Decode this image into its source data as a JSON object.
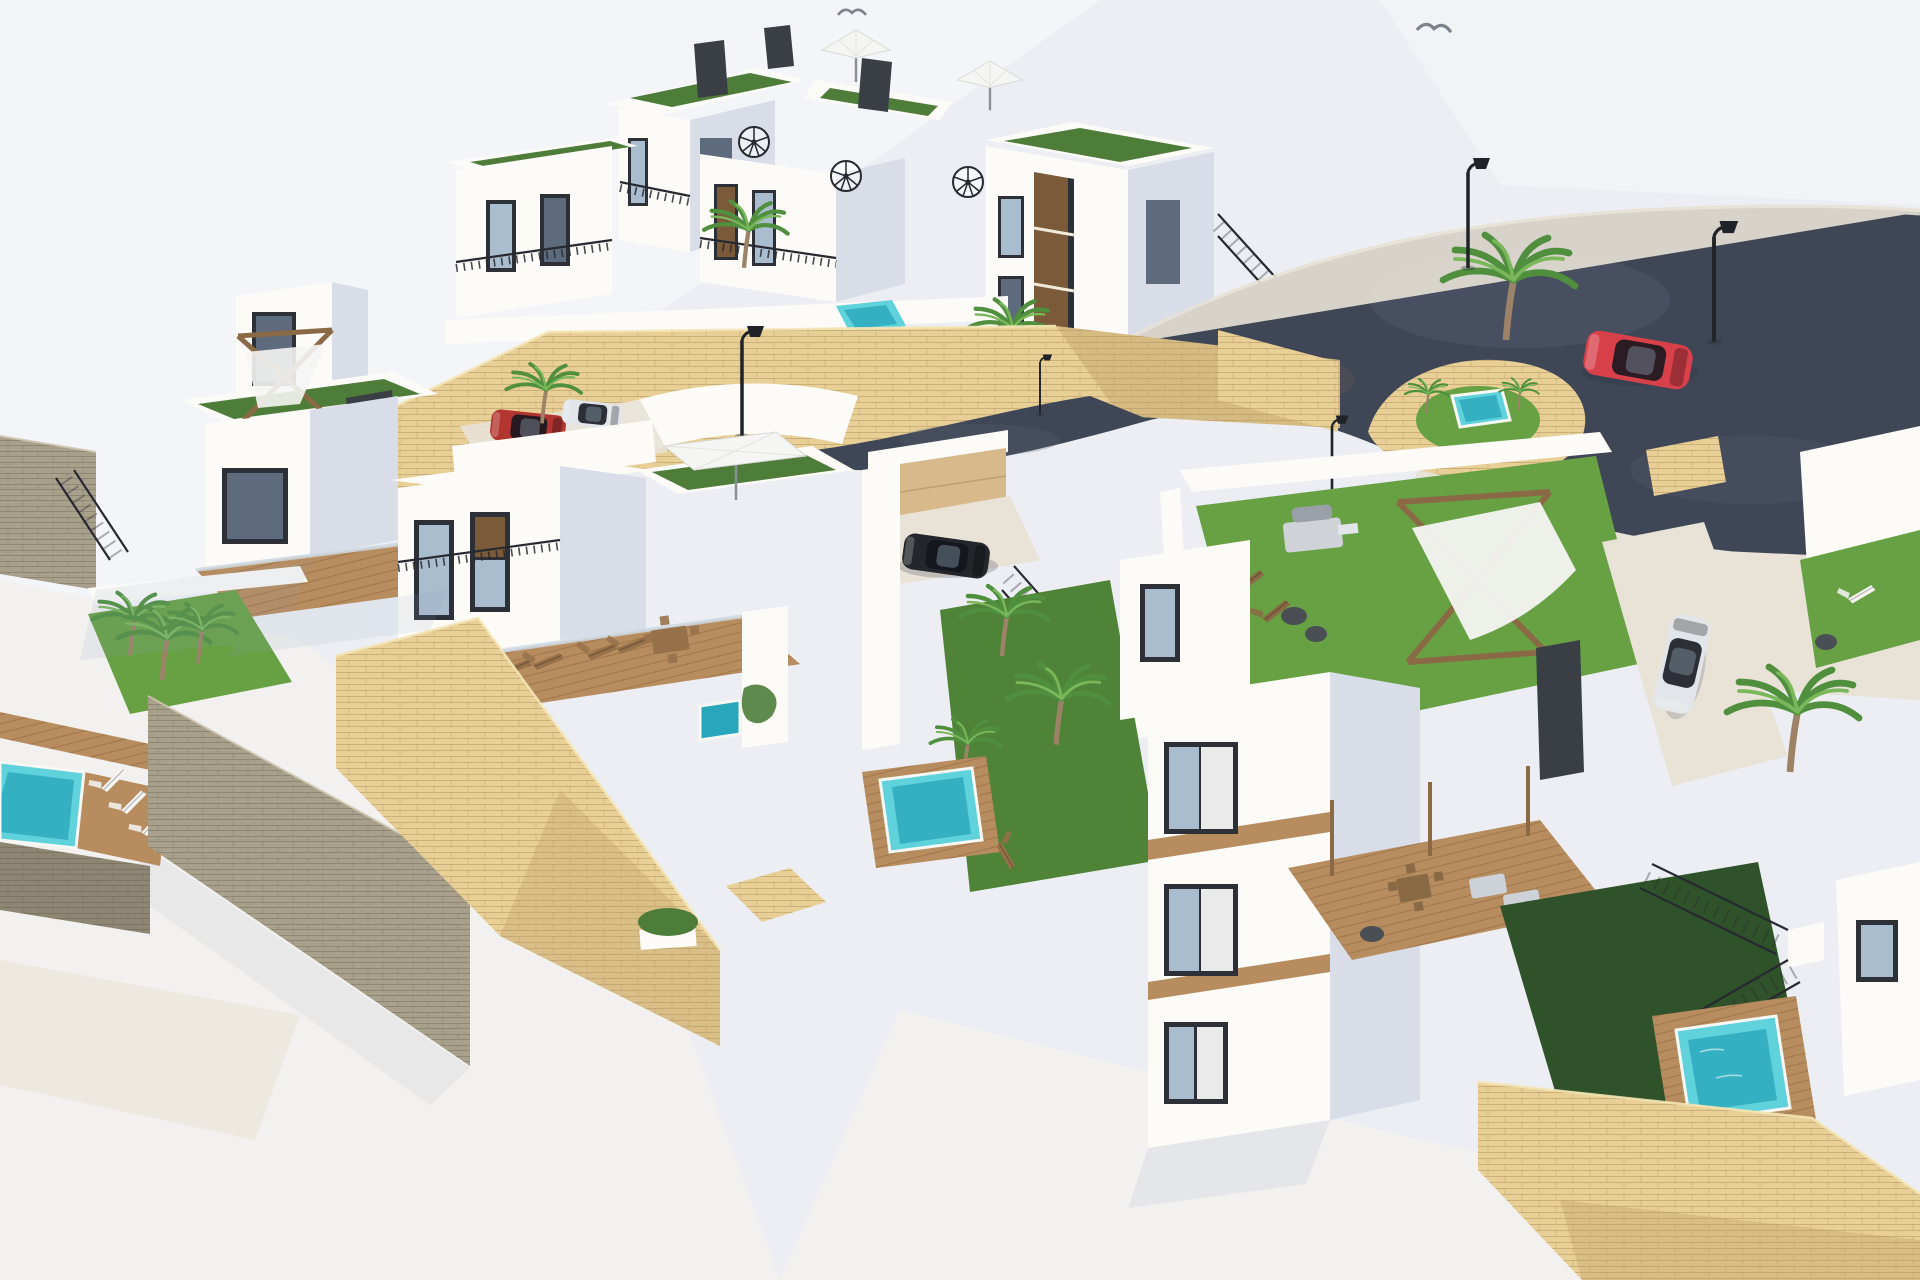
{
  "scene": {
    "kind": "3D architectural rendering",
    "view": "aerial three-quarter view",
    "subject": "Hillside residential development of modern white villas with rooftop terraces, private pools, palm trees, sandstone retaining walls and a curving access road",
    "text_on_screen": "none"
  },
  "palette": {
    "skyBase": "#eceef3",
    "skyHigh": "#f6f7f9",
    "groundLight": "#f2f1ef",
    "groundWarm": "#eae2d4",
    "villaLit": "#fcfbf8",
    "villaCream": "#f3ead8",
    "villaShade": "#d8dde8",
    "villaDark": "#c2cbdb",
    "panelDark": "#3a3f46",
    "windowFrame": "#2d3137",
    "windowGlass": "#aabdce",
    "glassDark": "#5e6b7c",
    "panelBrown": "#7b5a3a",
    "turfRoof": "#4e7d3a",
    "turfBright": "#67a144",
    "turfMid": "#4f8337",
    "turfDark": "#30522a",
    "stoneLit": "#e8cf96",
    "stoneMid": "#d8ba7c",
    "stoneShade": "#b2945f",
    "stoneGray": "#a9a08c",
    "stoneGrayDark": "#8e8673",
    "tileTan": "#d8b98c",
    "deckWood": "#b78c5e",
    "deckWoodDark": "#97714a",
    "poolLight": "#5fd2dc",
    "poolDeep": "#2aa6bc",
    "roadAsphalt": "#3f4756",
    "roadLight": "#5d6577",
    "roadBrown": "#675d52",
    "pavement": "#e8e2d7",
    "railing": "#26292f",
    "pergolaWood": "#8a6a45",
    "sailWhite": "#f5f5f3",
    "palmFrond": "#4f8f3e",
    "palmFrondLight": "#79b75a",
    "palmTrunk": "#9c8266",
    "carRed": "#d8404a",
    "carSuvRed": "#b23530",
    "carDark": "#23262b",
    "carWhite": "#e2e6ea",
    "lampPole": "#1f2328",
    "birdGray": "#7d838d",
    "shadowSoft": "#8fa0ba"
  },
  "inventory": {
    "birds": 2,
    "street_lamps": 5,
    "white_villa_volumes": 12,
    "swimming_pools": 7,
    "palm_trees": 13,
    "umbrella_parasols": 2,
    "square_parasols": 1,
    "pergola_shade_sails": 2,
    "spiral_staircases": 3,
    "sun_loungers": 18,
    "bbq_grills": 1,
    "outdoor_dining_sets": 2,
    "cars": [
      {
        "name": "red-hatchback",
        "palette_key": "carRed",
        "location": "asphalt road, upper right"
      },
      {
        "name": "white-compact",
        "palette_key": "carWhite",
        "location": "paved driveway, right side"
      },
      {
        "name": "dark-sedan",
        "palette_key": "carDark",
        "location": "central driveway behind wall"
      },
      {
        "name": "red-suv",
        "palette_key": "carSuvRed",
        "location": "carport, center-left"
      },
      {
        "name": "white-coupe",
        "palette_key": "carWhite",
        "location": "carport, center-left"
      }
    ]
  }
}
